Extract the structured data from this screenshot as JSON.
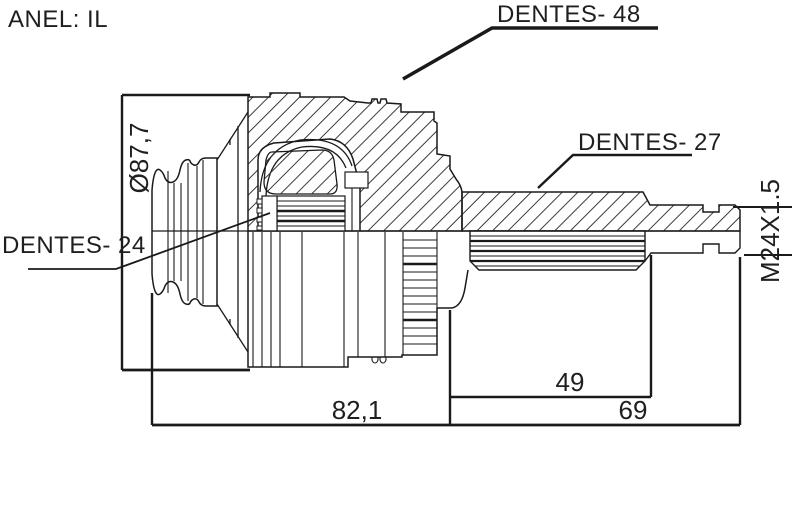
{
  "drawing": {
    "type": "cv-joint-technical-drawing-half-section",
    "ring_note": "ANEL: IL",
    "callouts": {
      "teeth_outer_ring": "DENTES- 48",
      "teeth_shaft_spline": "DENTES- 27",
      "teeth_inner_spline": "DENTES- 24"
    },
    "dimensions": {
      "outer_diameter": "Ø87,7",
      "thread_spec": "M24X1.5",
      "spline_length": "49",
      "shaft_length": "69",
      "body_length": "82,1"
    },
    "colors": {
      "line": "#1a1a1a",
      "background": "#ffffff"
    }
  }
}
